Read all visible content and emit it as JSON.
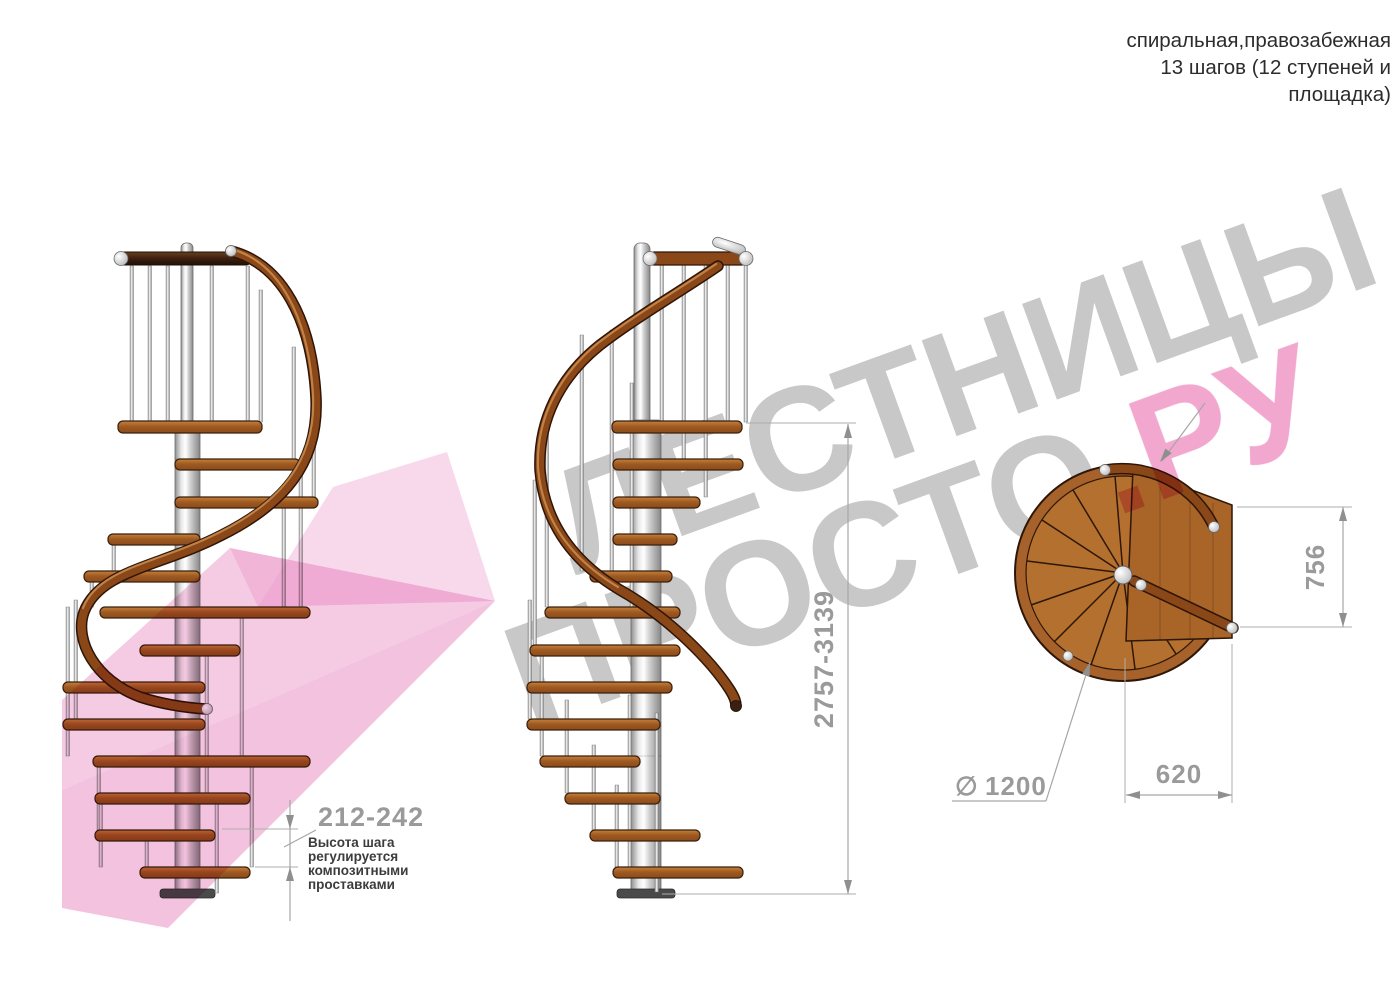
{
  "title": {
    "lines": [
      "спиральная,правозабежная",
      "13 шагов (12 ступеней и",
      "площадка)"
    ]
  },
  "watermark": {
    "word1": "ЛЕСТНИЦЫ",
    "word2_gray": "ПРОСТО",
    "word2_pink": ".РУ"
  },
  "dimensions": {
    "step_height": "212-242",
    "step_note": [
      "Высота шага",
      "регулируется",
      "композитными",
      "проставками"
    ],
    "total_height": "2757-3139",
    "plan_depth": "756",
    "plan_width": "620",
    "diameter_symbol": "∅",
    "diameter_value": "1200"
  },
  "colors": {
    "wood": "#a9622a",
    "rail_wood": "#8a4718",
    "dark_rail": "#3b2010",
    "steel": "#d9d9d9",
    "dim_gray": "#9a9a9a",
    "note_text": "#3c3c3c",
    "title_text": "#2c2c2c",
    "watermark_gray": "#c8c8c8",
    "watermark_pink": "#f2a8ce",
    "arrow_pink": "#ec9ccb"
  }
}
